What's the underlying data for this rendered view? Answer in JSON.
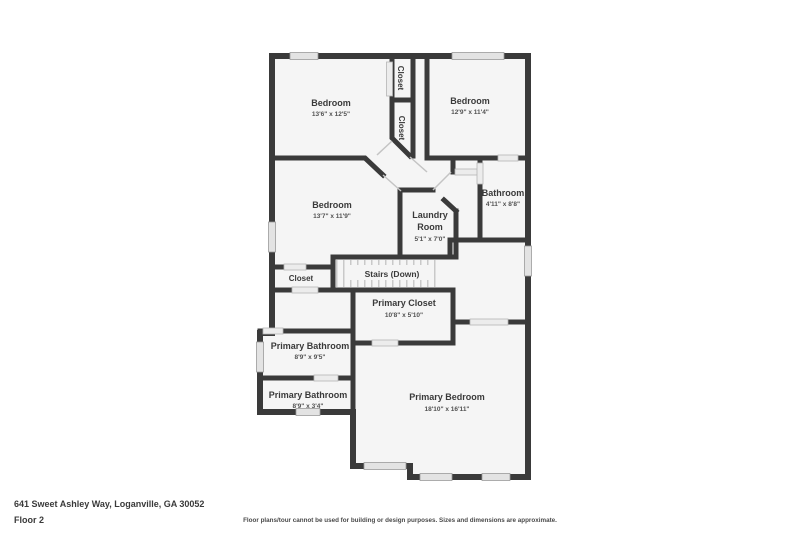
{
  "floorplan": {
    "rooms": [
      {
        "id": "bedroom-top-left",
        "name": "Bedroom",
        "dims": "13'6\" x 12'5\""
      },
      {
        "id": "bedroom-top-right",
        "name": "Bedroom",
        "dims": "12'9\" x 11'4\""
      },
      {
        "id": "closet-top",
        "name": "Closet"
      },
      {
        "id": "closet-mid",
        "name": "Closet"
      },
      {
        "id": "bedroom-middle",
        "name": "Bedroom",
        "dims": "13'7\" x 11'9\""
      },
      {
        "id": "bathroom",
        "name": "Bathroom",
        "dims": "4'11\" x 8'8\""
      },
      {
        "id": "laundry-room",
        "name": "Laundry Room",
        "name_lines": [
          "Laundry",
          "Room"
        ],
        "dims": "5'1\" x 7'0\""
      },
      {
        "id": "stairs",
        "name": "Stairs (Down)"
      },
      {
        "id": "closet-left",
        "name": "Closet"
      },
      {
        "id": "primary-closet",
        "name": "Primary Closet",
        "dims": "10'8\" x 5'10\""
      },
      {
        "id": "primary-bathroom-upper",
        "name": "Primary Bathroom",
        "dims": "8'9\" x 9'5\""
      },
      {
        "id": "primary-bathroom-lower",
        "name": "Primary Bathroom",
        "dims": "8'9\" x 3'4\""
      },
      {
        "id": "primary-bedroom",
        "name": "Primary Bedroom",
        "dims": "18'10\" x 16'11\""
      }
    ],
    "colors": {
      "wall": "#3a3a3a",
      "floor": "#f5f5f5",
      "window": "#e3e3e3",
      "door": "#ececec",
      "tread": "#c9c9c9"
    }
  },
  "footer": {
    "address": "641 Sweet Ashley Way, Loganville, GA 30052",
    "floor_label": "Floor 2",
    "disclaimer": "Floor plans/tour cannot be used for building or design purposes. Sizes and dimensions are approximate."
  }
}
